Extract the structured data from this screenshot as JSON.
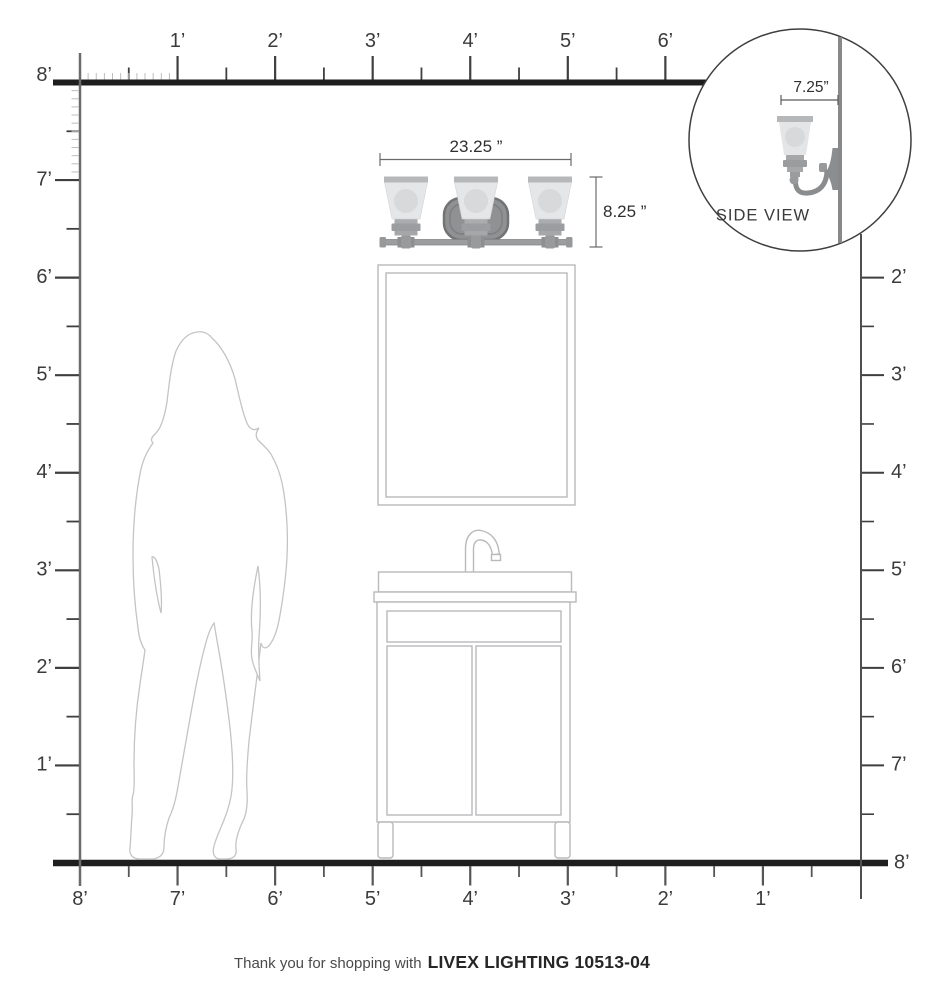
{
  "page": {
    "caption_regular": "Thank you for shopping with",
    "caption_bold": "LIVEX LIGHTING 10513-04"
  },
  "fixture": {
    "name": "3-light-vanity-fixture",
    "width_label": "23.25 ”",
    "height_label": "8.25 ”"
  },
  "side_view": {
    "label": "SIDE VIEW",
    "depth_label": "7.25”"
  },
  "rulers": {
    "unit": "feet",
    "top": {
      "labels": [
        "1’",
        "2’",
        "3’",
        "4’",
        "5’",
        "6’"
      ]
    },
    "left": {
      "labels": [
        "8’",
        "7’",
        "6’",
        "5’",
        "4’",
        "3’",
        "2’",
        "1’"
      ]
    },
    "right": {
      "labels": [
        "2’",
        "3’",
        "4’",
        "5’",
        "6’",
        "7’",
        "8’"
      ]
    },
    "bottom": {
      "labels": [
        "8’",
        "7’",
        "6’",
        "5’",
        "4’",
        "3’",
        "2’",
        "1’"
      ]
    }
  },
  "colors": {
    "ceiling_floor_line": "#1e1e1e",
    "wall_line": "#6b6b6b",
    "tick": "#3f3f3f",
    "tick_minor_inch": "#bdbdbd",
    "glass_shade": "#e5e6e7",
    "bulb": "#d8d9da",
    "metal": "#9b9da0",
    "backplate": "#8f9193",
    "outline_gray": "#b9babb",
    "text": "#3b3b3b"
  }
}
